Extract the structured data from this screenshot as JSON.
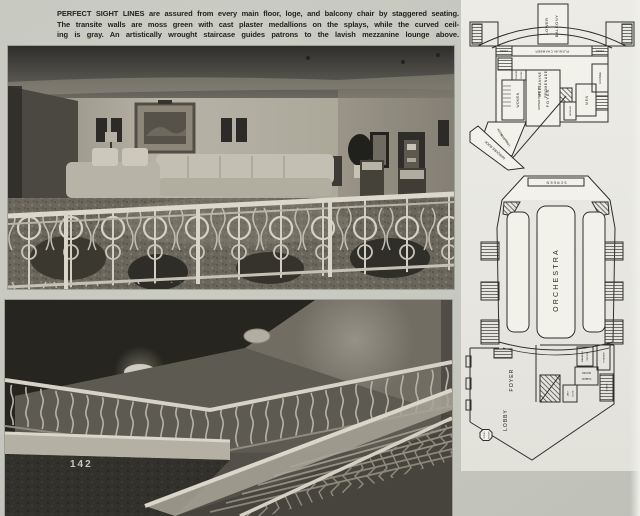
{
  "page": {
    "number": "142",
    "caption_lines": [
      "PERFECT SIGHT LINES are assured from every main floor, loge, and balcony chair by staggered seating.",
      "The transite walls are moss green with cast plaster medallions on the splays, while the curved ceil-",
      "ing is gray. An artistically wrought staircase guides patrons to the lavish mezzanine lounge above."
    ]
  },
  "plans": {
    "mezzanine_level": {
      "labels": {
        "lower": "LOWER",
        "balcony": "BALCONY",
        "stairs_left": "STAIRS",
        "stairs_right": "STAIRS",
        "plenum_chamber": "PLENUM CHAMBER",
        "mezzanine": "MEZZANINE",
        "promenade": "PROMENADE",
        "upper_part_of": "UPPER PART OF",
        "foyer": "FOYER",
        "women": "WOMEN",
        "powder": "POWDER",
        "powder_room": "ROOM",
        "men": "MEN",
        "lounge": "LOUNGE",
        "smoking": "SMOKING",
        "roof": "ROOF",
        "and": "AND",
        "lobby": "LOBBY",
        "marquee_roof": "MARQUEE ROOF"
      }
    },
    "orchestra_level": {
      "labels": {
        "screen": "SCREEN",
        "orchestra": "ORCHESTRA",
        "foyer": "FOYER",
        "lobby": "LOBBY",
        "check": "CHECK",
        "check_room": "ROOM",
        "manager": "MANAGER",
        "office": "OFFICE",
        "storage": "STORAGE",
        "janitor": "JAN'T",
        "closet": "CLOS.",
        "stairs": "STAIRS",
        "ticket": "TICKET",
        "booth": "BOOTH"
      }
    }
  },
  "colors": {
    "paper": "#c6c8bf",
    "plan_panel": "#e8e7e1",
    "ink": "#26261f",
    "photo_highlight": "#d6d2c6",
    "photo_shadow": "#2b2a27"
  }
}
